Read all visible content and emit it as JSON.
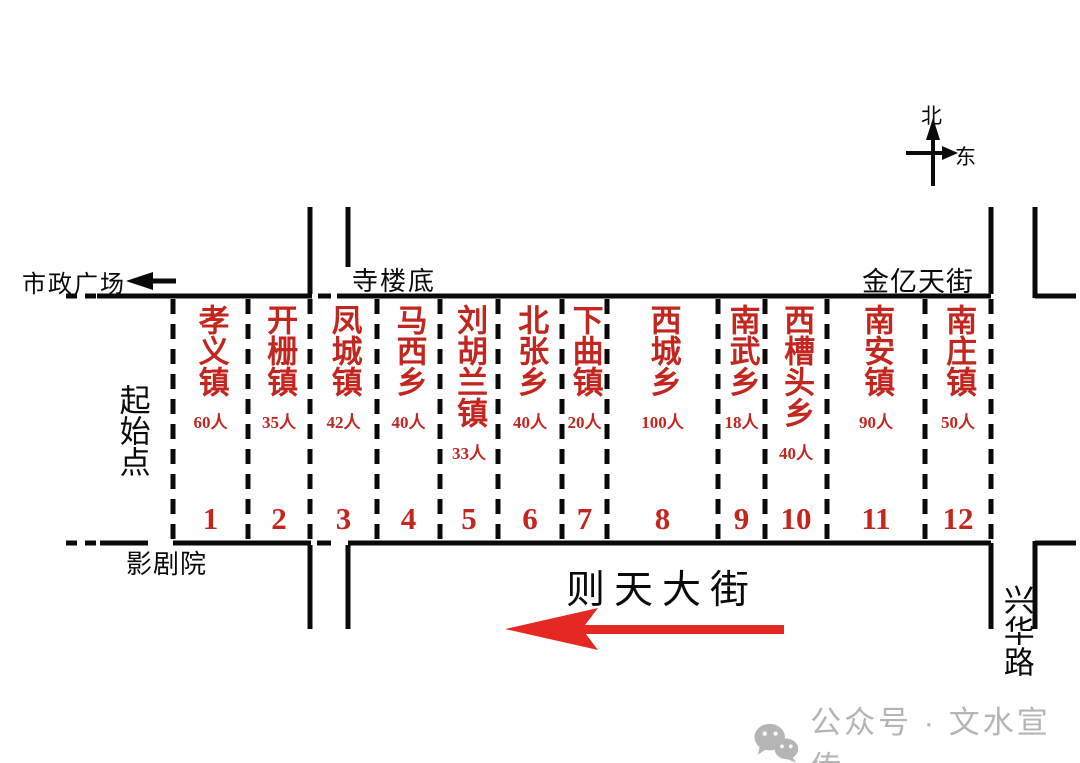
{
  "compass": {
    "north": "北",
    "east": "东"
  },
  "landmarks": {
    "municipal_square": "市政广场",
    "silou_di": "寺楼底",
    "jinyi_tian_street": "金亿天街",
    "starting_point": "起始点",
    "theater": "影剧院",
    "xinghua_road": "兴华路"
  },
  "main_street": {
    "name": "则天大街"
  },
  "sections": [
    {
      "number": "1",
      "name": "孝义镇",
      "count": "60人"
    },
    {
      "number": "2",
      "name": "开栅镇",
      "count": "35人"
    },
    {
      "number": "3",
      "name": "凤城镇",
      "count": "42人"
    },
    {
      "number": "4",
      "name": "马西乡",
      "count": "40人"
    },
    {
      "number": "5",
      "name": "刘胡兰镇",
      "count": "33人"
    },
    {
      "number": "6",
      "name": "北张乡",
      "count": "40人"
    },
    {
      "number": "7",
      "name": "下曲镇",
      "count": "20人"
    },
    {
      "number": "8",
      "name": "西城乡",
      "count": "100人"
    },
    {
      "number": "9",
      "name": "南武乡",
      "count": "18人"
    },
    {
      "number": "10",
      "name": "西槽头乡",
      "count": "40人"
    },
    {
      "number": "11",
      "name": "南安镇",
      "count": "90人"
    },
    {
      "number": "12",
      "name": "南庄镇",
      "count": "50人"
    }
  ],
  "watermark": {
    "text": "公众号 · 文水宣传"
  },
  "colors": {
    "red_text": "#c3261f",
    "arrow_red": "#e62823",
    "line_black": "#0a0a0a",
    "watermark_grey": "#b5b5b5"
  }
}
